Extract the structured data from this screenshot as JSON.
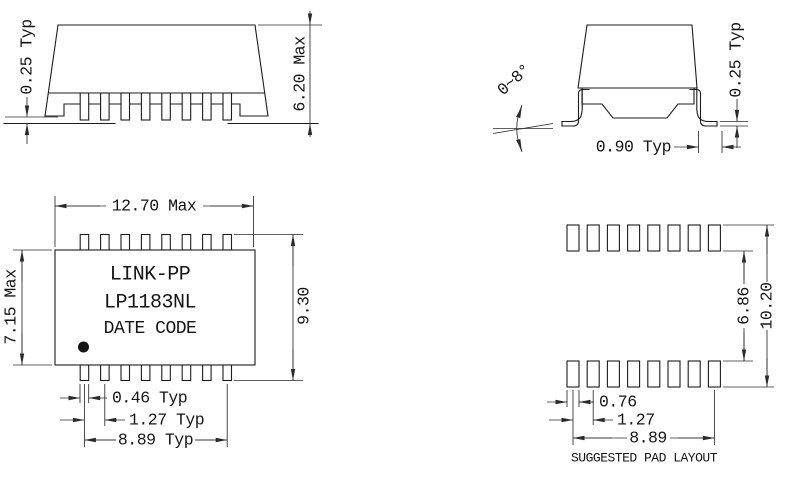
{
  "title": "LP1183NL package outline drawing",
  "colors": {
    "line": "#1c1c1c",
    "background": "#ffffff",
    "ink": "#151515"
  },
  "side_view": {
    "standoff_label": "0.25 Typ",
    "height_label": "6.20 Max",
    "pin_count": 8
  },
  "end_view": {
    "angle_label": "0~8°",
    "lead_thickness_label": "0.25 Typ",
    "foot_length_label": "0.90 Typ"
  },
  "top_view": {
    "width_label": "12.70 Max",
    "body_height_label": "7.15 Max",
    "overall_height_label": "9.30",
    "lead_width_label": "0.46 Typ",
    "lead_pitch_label": "1.27 Typ",
    "lead_span_label": "8.89 Typ",
    "brand": "LINK-PP",
    "part_number": "LP1183NL",
    "marking_line": "DATE CODE",
    "pins_per_row": 8
  },
  "pad_layout": {
    "row_gap_label": "6.86",
    "outer_span_label": "10.20",
    "pad_width_label": "0.76",
    "pad_pitch_label": "1.27",
    "pad_span_label": "8.89",
    "caption": "SUGGESTED PAD LAYOUT",
    "pads_per_row": 8
  }
}
